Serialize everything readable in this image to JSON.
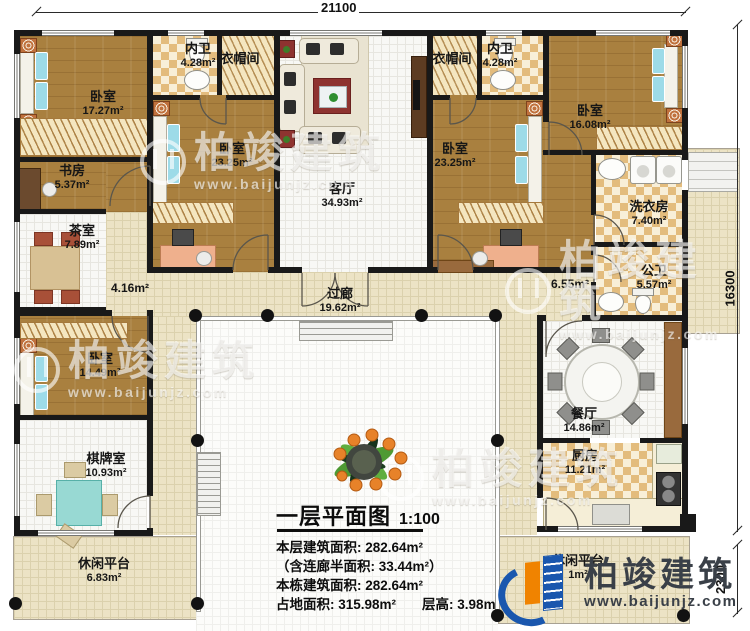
{
  "plan": {
    "title": "一层平面图",
    "scale": "1:100",
    "stats": {
      "line1": "本层建筑面积: 282.64m²",
      "line2": "（含连廊半面积: 33.44m²）",
      "line3": "本栋建筑面积: 282.64m²",
      "line4a": "占地面积: 315.98m²",
      "line4b": "层高: 3.98m"
    }
  },
  "dimensions": {
    "top": "21100",
    "right": "16300",
    "right_lower": "2300"
  },
  "rooms": {
    "bedroom_tl": {
      "name": "卧室",
      "area": "17.27m²"
    },
    "bath_left": {
      "name": "内卫",
      "area": "4.28m²"
    },
    "cloak_left": {
      "name": "衣帽间",
      "area": ""
    },
    "bedroom_l": {
      "name": "卧室",
      "area": "23.25m²"
    },
    "study": {
      "name": "书房",
      "area": "5.37m²"
    },
    "tea": {
      "name": "茶室",
      "area": "7.89m²"
    },
    "living": {
      "name": "客厅",
      "area": "34.93m²"
    },
    "cloak_right": {
      "name": "衣帽间",
      "area": ""
    },
    "bath_right": {
      "name": "内卫",
      "area": "4.28m²"
    },
    "bedroom_r": {
      "name": "卧室",
      "area": "23.25m²"
    },
    "bedroom_tr": {
      "name": "卧室",
      "area": "16.08m²"
    },
    "laundry": {
      "name": "洗衣房",
      "area": "7.40m²"
    },
    "public_wc": {
      "name": "公卫",
      "area": "5.57m²"
    },
    "corridor": {
      "name": "过廊",
      "area": "19.62m²"
    },
    "hall_left": {
      "name": "",
      "area": "4.16m²"
    },
    "hall_right": {
      "name": "",
      "area": "6.55m²"
    },
    "bedroom_bl": {
      "name": "卧室",
      "area": "14.49m²"
    },
    "chess": {
      "name": "棋牌室",
      "area": "10.93m²"
    },
    "porch_left": {
      "name": "休闲平台",
      "area": "6.83m²"
    },
    "dining": {
      "name": "餐厅",
      "area": "14.86m²"
    },
    "kitchen": {
      "name": "厨房",
      "area": "11.21m²"
    },
    "porch_right": {
      "name": "休闲平台",
      "area": "1m²"
    }
  },
  "watermark": {
    "text": "柏竣建筑",
    "url": "www.baijunjz.com"
  },
  "logo": {
    "text": "柏竣建筑",
    "url": "www.baijunjz.com"
  },
  "colors": {
    "wall": "#191919",
    "wood_floor": "#a9803f",
    "walkway": "#ece3c5",
    "checker": "#e3bc7d",
    "bed_blue": "#62c5d9",
    "accent_red": "#8e3330",
    "logo_blue": "#1a57ae",
    "logo_orange": "#f08300"
  }
}
